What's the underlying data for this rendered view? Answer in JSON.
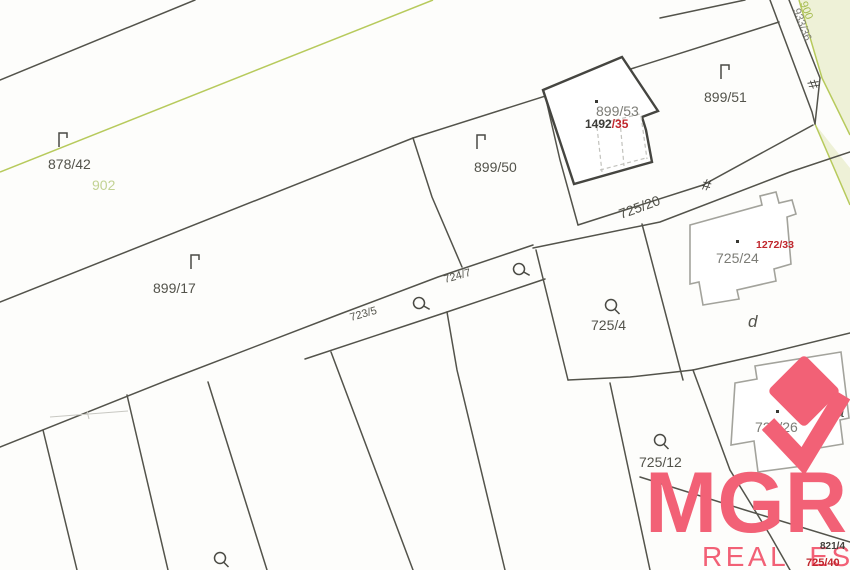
{
  "map": {
    "parcel_labels": [
      {
        "id": "878/42",
        "text": "878/42"
      },
      {
        "id": "902",
        "text": "902"
      },
      {
        "id": "899/17",
        "text": "899/17"
      },
      {
        "id": "899/50",
        "text": "899/50"
      },
      {
        "id": "899/53",
        "text": "899/53"
      },
      {
        "id": "899/51",
        "text": "899/51"
      },
      {
        "id": "933/36",
        "text": "933/36"
      },
      {
        "id": "900",
        "text": "900"
      },
      {
        "id": "725/20",
        "text": "725/20"
      },
      {
        "id": "723/5",
        "text": "723/5"
      },
      {
        "id": "724/7",
        "text": "724/7"
      },
      {
        "id": "725/4",
        "text": "725/4"
      },
      {
        "id": "725/24",
        "text": "725/24"
      },
      {
        "id": "725/12",
        "text": "725/12"
      },
      {
        "id": "725/26",
        "text": "725/26"
      },
      {
        "id": "part-d",
        "text": "d"
      },
      {
        "id": "part-a",
        "text": "a"
      }
    ],
    "building_numbers": [
      {
        "black": "1492",
        "red": "/35"
      },
      {
        "red": "1272/33"
      },
      {
        "black": "821/4"
      },
      {
        "red": "725/40"
      }
    ],
    "symbols": {
      "fence_glyph": "#",
      "grass_symbol": "grass-symbol-icon",
      "orchard_symbol": "orchard-symbol-icon",
      "building_point": "building-point-icon"
    },
    "colors": {
      "boundary": "#53534b",
      "green_line": "#b7ca5c",
      "green_fill": "#eef1d7",
      "building_outline_dark": "#454540",
      "building_outline_light": "#a3a39c",
      "label": "#53534b",
      "label_gray": "#7c7c76",
      "label_green": "#c2d293",
      "red": "#c0272d"
    }
  },
  "watermark": {
    "brand": "MGRE",
    "tagline": "REAL ESTATE",
    "color": "#f26176"
  }
}
